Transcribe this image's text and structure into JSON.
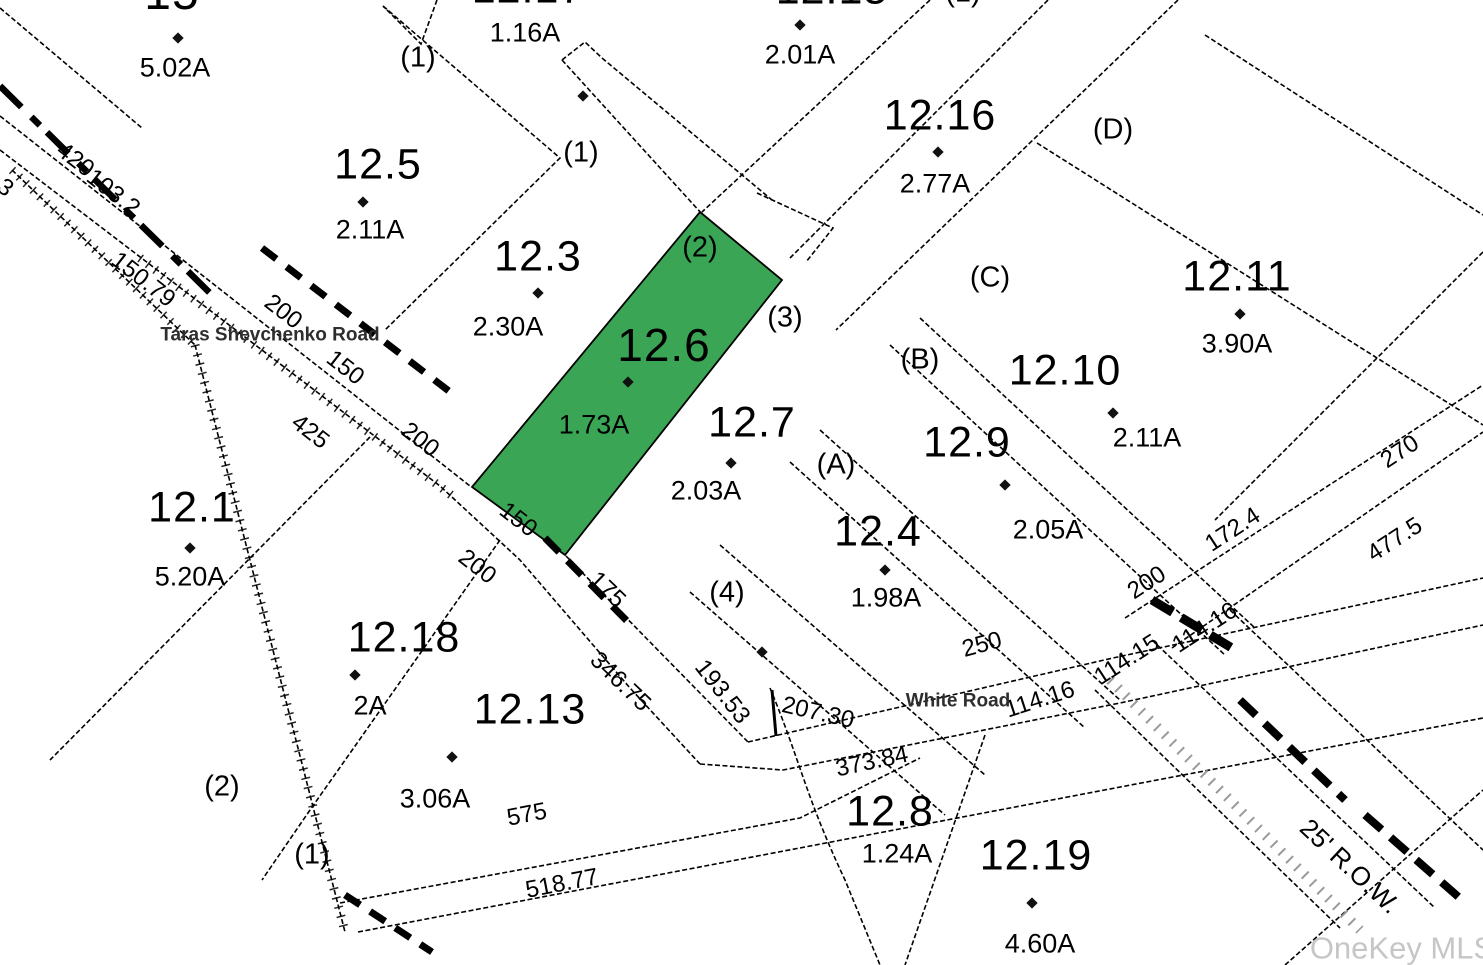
{
  "map": {
    "type": "tax-parcel-plat-map",
    "highlight_color": "#3aa655",
    "line_color": "#000000",
    "watermark": {
      "text": "OneKey MLS",
      "x": 1402,
      "y": 948
    },
    "roads": [
      {
        "name": "Taras Shevchenko Road",
        "x": 270,
        "y": 335,
        "rot": 0
      },
      {
        "name": "White Road",
        "x": 958,
        "y": 701,
        "rot": 0
      }
    ],
    "right_of_way": {
      "text": "25' R.O.W.",
      "x": 1350,
      "y": 866,
      "rot": 43
    },
    "parcels": [
      {
        "number": "15",
        "nx": 172,
        "ny": -6,
        "nsize": 48,
        "acreage": "5.02A",
        "ax": 175,
        "ay": 68,
        "dot": [
          178,
          38
        ],
        "highlighted": false
      },
      {
        "number": "12.5",
        "nx": 378,
        "ny": 165,
        "nsize": 43,
        "acreage": "2.11A",
        "ax": 370,
        "ay": 230,
        "dot": [
          363,
          202
        ],
        "highlighted": false
      },
      {
        "number": "12.17",
        "nx": 528,
        "ny": -11,
        "nsize": 43,
        "acreage": "1.16A",
        "ax": 525,
        "ay": 33,
        "dot": null,
        "highlighted": false
      },
      {
        "number": "12.3",
        "nx": 538,
        "ny": 257,
        "nsize": 43,
        "acreage": "2.30A",
        "ax": 508,
        "ay": 327,
        "dot": [
          538,
          293
        ],
        "highlighted": false
      },
      {
        "number": "12.15",
        "nx": 832,
        "ny": -10,
        "nsize": 43,
        "acreage": "2.01A",
        "ax": 800,
        "ay": 55,
        "dot": [
          800,
          25
        ],
        "highlighted": false
      },
      {
        "number": "12.16",
        "nx": 940,
        "ny": 116,
        "nsize": 43,
        "acreage": "2.77A",
        "ax": 935,
        "ay": 184,
        "dot": [
          938,
          152
        ],
        "highlighted": false
      },
      {
        "number": "12.11",
        "nx": 1237,
        "ny": 277,
        "nsize": 43,
        "acreage": "3.90A",
        "ax": 1237,
        "ay": 344,
        "dot": [
          1240,
          314
        ],
        "highlighted": false
      },
      {
        "number": "12.10",
        "nx": 1065,
        "ny": 371,
        "nsize": 43,
        "acreage": "2.11A",
        "ax": 1147,
        "ay": 438,
        "dot": [
          1113,
          413
        ],
        "highlighted": false
      },
      {
        "number": "12.9",
        "nx": 967,
        "ny": 443,
        "nsize": 43,
        "acreage": "2.05A",
        "ax": 1048,
        "ay": 530,
        "dot": [
          1005,
          485
        ],
        "highlighted": false
      },
      {
        "number": "12.6",
        "nx": 664,
        "ny": 345,
        "nsize": 46,
        "acreage": "1.73A",
        "ax": 594,
        "ay": 425,
        "dot": [
          628,
          382
        ],
        "highlighted": true
      },
      {
        "number": "12.7",
        "nx": 752,
        "ny": 423,
        "nsize": 43,
        "acreage": "2.03A",
        "ax": 706,
        "ay": 491,
        "dot": [
          731,
          463
        ],
        "highlighted": false
      },
      {
        "number": "12.4",
        "nx": 878,
        "ny": 532,
        "nsize": 43,
        "acreage": "1.98A",
        "ax": 886,
        "ay": 598,
        "dot": [
          885,
          570
        ],
        "highlighted": false
      },
      {
        "number": "12.1",
        "nx": 192,
        "ny": 508,
        "nsize": 43,
        "acreage": "5.20A",
        "ax": 190,
        "ay": 577,
        "dot": [
          190,
          548
        ],
        "highlighted": false
      },
      {
        "number": "12.18",
        "nx": 404,
        "ny": 638,
        "nsize": 43,
        "acreage": "2A",
        "ax": 370,
        "ay": 706,
        "dot": [
          355,
          675
        ],
        "highlighted": false
      },
      {
        "number": "12.13",
        "nx": 530,
        "ny": 710,
        "nsize": 43,
        "acreage": "3.06A",
        "ax": 435,
        "ay": 799,
        "dot": [
          452,
          757
        ],
        "highlighted": false
      },
      {
        "number": "12.8",
        "nx": 890,
        "ny": 812,
        "nsize": 43,
        "acreage": "1.24A",
        "ax": 897,
        "ay": 854,
        "dot": null,
        "highlighted": false
      },
      {
        "number": "12.19",
        "nx": 1036,
        "ny": 856,
        "nsize": 43,
        "acreage": "4.60A",
        "ax": 1040,
        "ay": 944,
        "dot": [
          1032,
          903
        ],
        "highlighted": false
      }
    ],
    "extra_dots": [
      [
        583,
        96
      ],
      [
        762,
        652
      ]
    ],
    "lot_refs": [
      {
        "text": "(1)",
        "x": 418,
        "y": 58
      },
      {
        "text": "(1)",
        "x": 581,
        "y": 153
      },
      {
        "text": "(1)",
        "x": 963,
        "y": -7
      },
      {
        "text": "(2)",
        "x": 700,
        "y": 248
      },
      {
        "text": "(3)",
        "x": 785,
        "y": 318
      },
      {
        "text": "(D)",
        "x": 1113,
        "y": 130
      },
      {
        "text": "(C)",
        "x": 990,
        "y": 278
      },
      {
        "text": "(B)",
        "x": 920,
        "y": 360
      },
      {
        "text": "(A)",
        "x": 836,
        "y": 465
      },
      {
        "text": "(4)",
        "x": 727,
        "y": 593
      },
      {
        "text": "(2)",
        "x": 222,
        "y": 787
      },
      {
        "text": "(1)",
        "x": 312,
        "y": 855
      }
    ],
    "dimensions": [
      {
        "text": "420",
        "x": 75,
        "y": 160,
        "rot": 38
      },
      {
        "text": "3",
        "x": 5,
        "y": 188,
        "rot": 38
      },
      {
        "text": "103.2",
        "x": 113,
        "y": 193,
        "rot": 38
      },
      {
        "text": "150.79",
        "x": 143,
        "y": 280,
        "rot": 38
      },
      {
        "text": "200",
        "x": 283,
        "y": 312,
        "rot": 38
      },
      {
        "text": "150",
        "x": 345,
        "y": 368,
        "rot": 38
      },
      {
        "text": "425",
        "x": 310,
        "y": 432,
        "rot": 38
      },
      {
        "text": "200",
        "x": 420,
        "y": 440,
        "rot": 38
      },
      {
        "text": "150",
        "x": 518,
        "y": 520,
        "rot": 38
      },
      {
        "text": "200",
        "x": 477,
        "y": 567,
        "rot": 38
      },
      {
        "text": "175",
        "x": 607,
        "y": 590,
        "rot": 44
      },
      {
        "text": "346.75",
        "x": 620,
        "y": 682,
        "rot": 44
      },
      {
        "text": "193.53",
        "x": 722,
        "y": 692,
        "rot": 52
      },
      {
        "text": "207.30",
        "x": 818,
        "y": 713,
        "rot": 13
      },
      {
        "text": "250",
        "x": 982,
        "y": 645,
        "rot": -15
      },
      {
        "text": "373.84",
        "x": 872,
        "y": 762,
        "rot": -12
      },
      {
        "text": "575",
        "x": 527,
        "y": 815,
        "rot": -11
      },
      {
        "text": "518.77",
        "x": 562,
        "y": 884,
        "rot": -11
      },
      {
        "text": "114.16",
        "x": 1040,
        "y": 700,
        "rot": -18
      },
      {
        "text": "114.15",
        "x": 1127,
        "y": 660,
        "rot": -33
      },
      {
        "text": "114.16",
        "x": 1205,
        "y": 628,
        "rot": -33
      },
      {
        "text": "200",
        "x": 1147,
        "y": 583,
        "rot": -33
      },
      {
        "text": "172.4",
        "x": 1233,
        "y": 530,
        "rot": -33
      },
      {
        "text": "270",
        "x": 1400,
        "y": 452,
        "rot": -33
      },
      {
        "text": "477.5",
        "x": 1395,
        "y": 540,
        "rot": -33
      }
    ]
  }
}
